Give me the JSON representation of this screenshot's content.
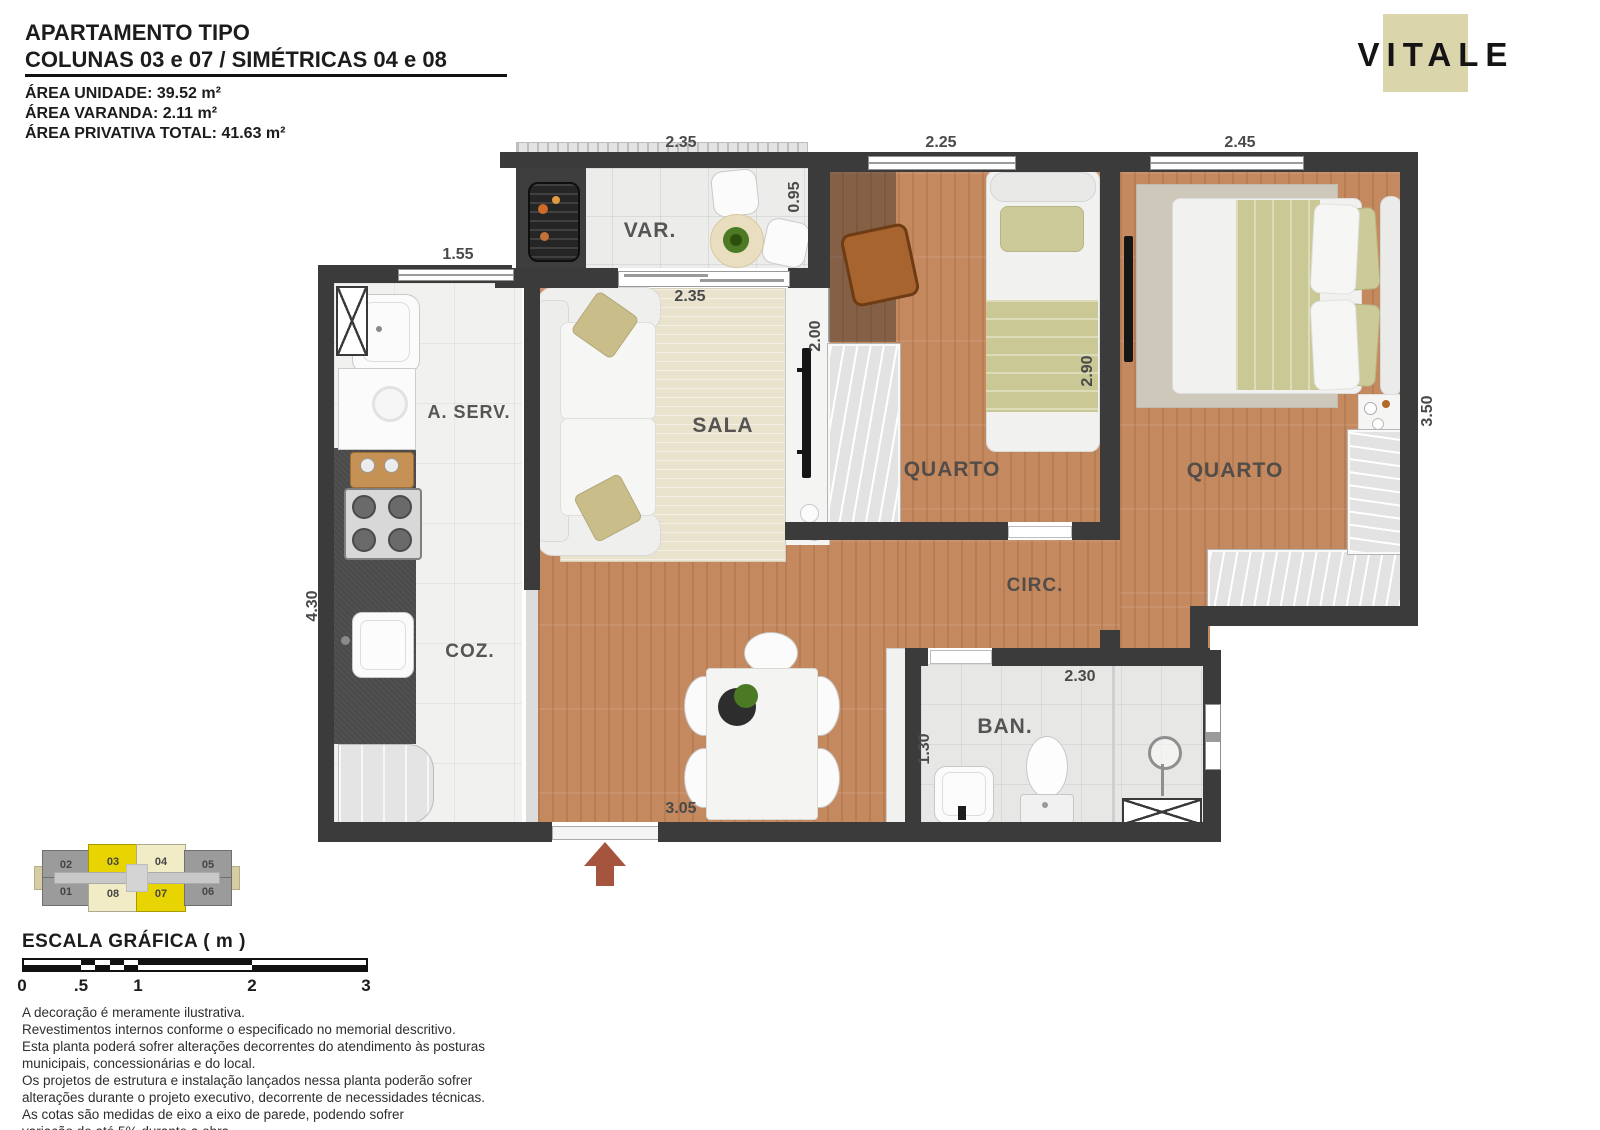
{
  "header": {
    "title_line1": "APARTAMENTO TIPO",
    "title_line2": "COLUNAS 03 e 07 / SIMÉTRICAS 04 e 08",
    "area_lines": [
      "ÁREA UNIDADE: 39.52 m²",
      "ÁREA VARANDA: 2.11 m²",
      "ÁREA PRIVATIVA TOTAL: 41.63 m²"
    ]
  },
  "logo": {
    "brand": "VITALE",
    "square_color": "#dbd5ab"
  },
  "plan": {
    "room_labels": {
      "varanda": "VAR.",
      "sala": "SALA",
      "quarto_1": "QUARTO",
      "quarto_2": "QUARTO",
      "circulacao": "CIRC.",
      "banheiro": "BAN.",
      "cozinha": "COZ.",
      "area_servico": "A. SERV."
    },
    "dimensions": {
      "varanda_width": "2.35",
      "quarto1_width": "2.25",
      "quarto2_width": "2.45",
      "cozinha_window": "1.55",
      "cozinha_depth": "4.30",
      "sala_width": "2.35",
      "varanda_depth": "0.95",
      "sala_tv_wall": "2.00",
      "quarto1_depth": "2.90",
      "quarto2_depth": "3.50",
      "entrada_width": "3.05",
      "banheiro_width": "2.30",
      "banheiro_depth": "1.30"
    }
  },
  "key_plan": {
    "units": [
      {
        "label": "02"
      },
      {
        "label": "03"
      },
      {
        "label": "04"
      },
      {
        "label": "05"
      },
      {
        "label": "01"
      },
      {
        "label": "08"
      },
      {
        "label": "07"
      },
      {
        "label": "06"
      }
    ]
  },
  "scale_bar": {
    "title": "ESCALA GRÁFICA ( m )",
    "ticks": [
      "0",
      ".5",
      "1",
      "2",
      "3"
    ]
  },
  "disclaimer": {
    "lines": [
      "A decoração é meramente ilustrativa.",
      "Revestimentos internos conforme o especificado no memorial descritivo.",
      "Esta planta poderá sofrer alterações decorrentes do atendimento às posturas",
      "municipais, concessionárias e do local.",
      "Os projetos de estrutura e instalação lançados nessa planta poderão sofrer",
      "alterações durante o projeto executivo, decorrente de necessidades técnicas.",
      "As cotas são medidas de eixo a eixo de parede, podendo sofrer",
      "variação de até 5% durante a obra"
    ]
  },
  "colors": {
    "wall": "#3b3b3b",
    "wood_floor": "#c5895f",
    "entry_arrow": "#a5543e",
    "logo_square": "#dbd5ab",
    "unit_highlight": "#e8d400",
    "unit_symmetric": "#f1ecc6"
  }
}
